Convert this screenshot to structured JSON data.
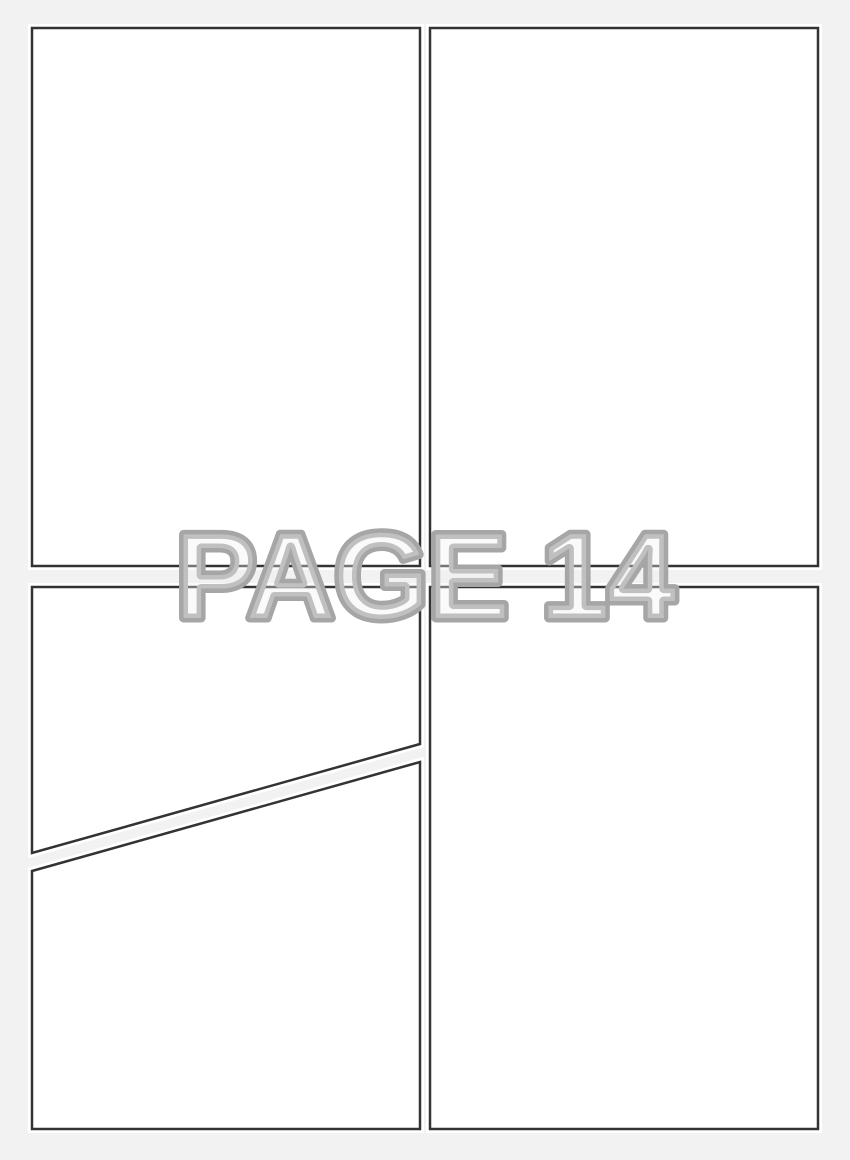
{
  "page": {
    "label": "PAGE 14"
  },
  "panels": {
    "count": 5,
    "items": [
      {
        "id": "top-left"
      },
      {
        "id": "top-right"
      },
      {
        "id": "bottom-left-upper"
      },
      {
        "id": "bottom-left-lower"
      },
      {
        "id": "bottom-right"
      }
    ]
  },
  "colors": {
    "background": "#f2f2f2",
    "panel_fill": "#ffffff",
    "panel_border": "#333333",
    "panel_glow": "#ffffff",
    "label_outline": "#a6a6a6",
    "label_fill": "#f2f2f2"
  }
}
